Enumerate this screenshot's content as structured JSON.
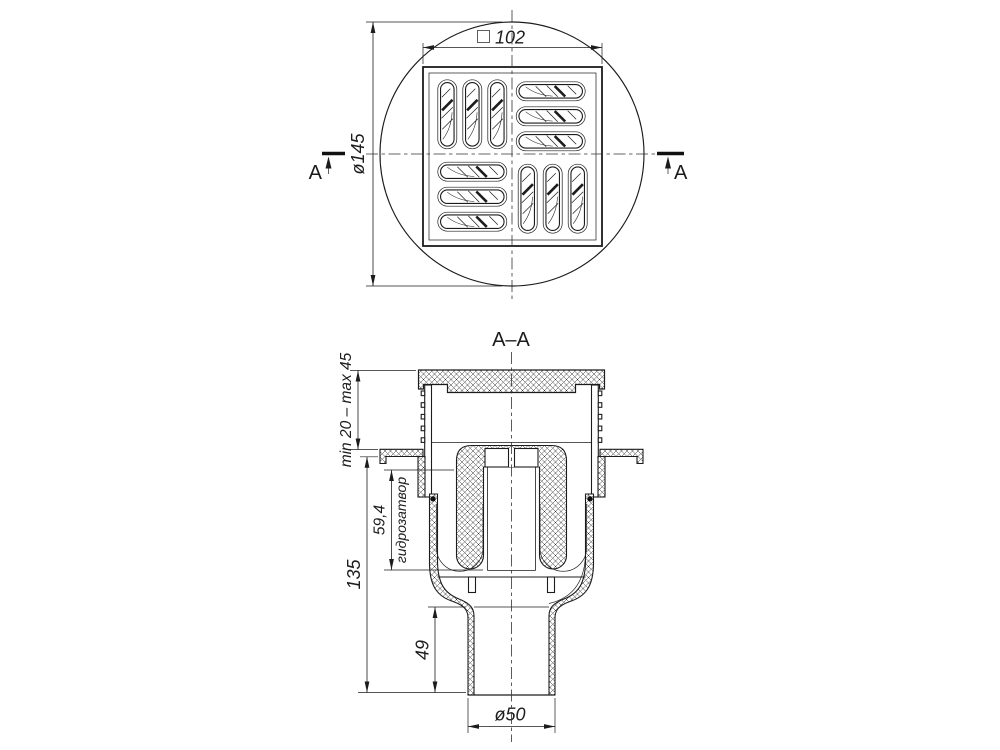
{
  "meta": {
    "background": "#ffffff",
    "line_color": "#1c1c1c",
    "drawing_type": "floor drain technical drawing"
  },
  "top_view": {
    "square_size": "102",
    "diameter": "ø145",
    "cut_letter_left": "A",
    "cut_letter_right": "A"
  },
  "section_view": {
    "title": "A–A",
    "dims": {
      "adjust_range": "min 20 – max 45",
      "seal_height": "59,4",
      "seal_label": "гидрозатвор",
      "overall_height": "135",
      "outlet_length": "49",
      "outlet_diameter": "ø50"
    }
  }
}
